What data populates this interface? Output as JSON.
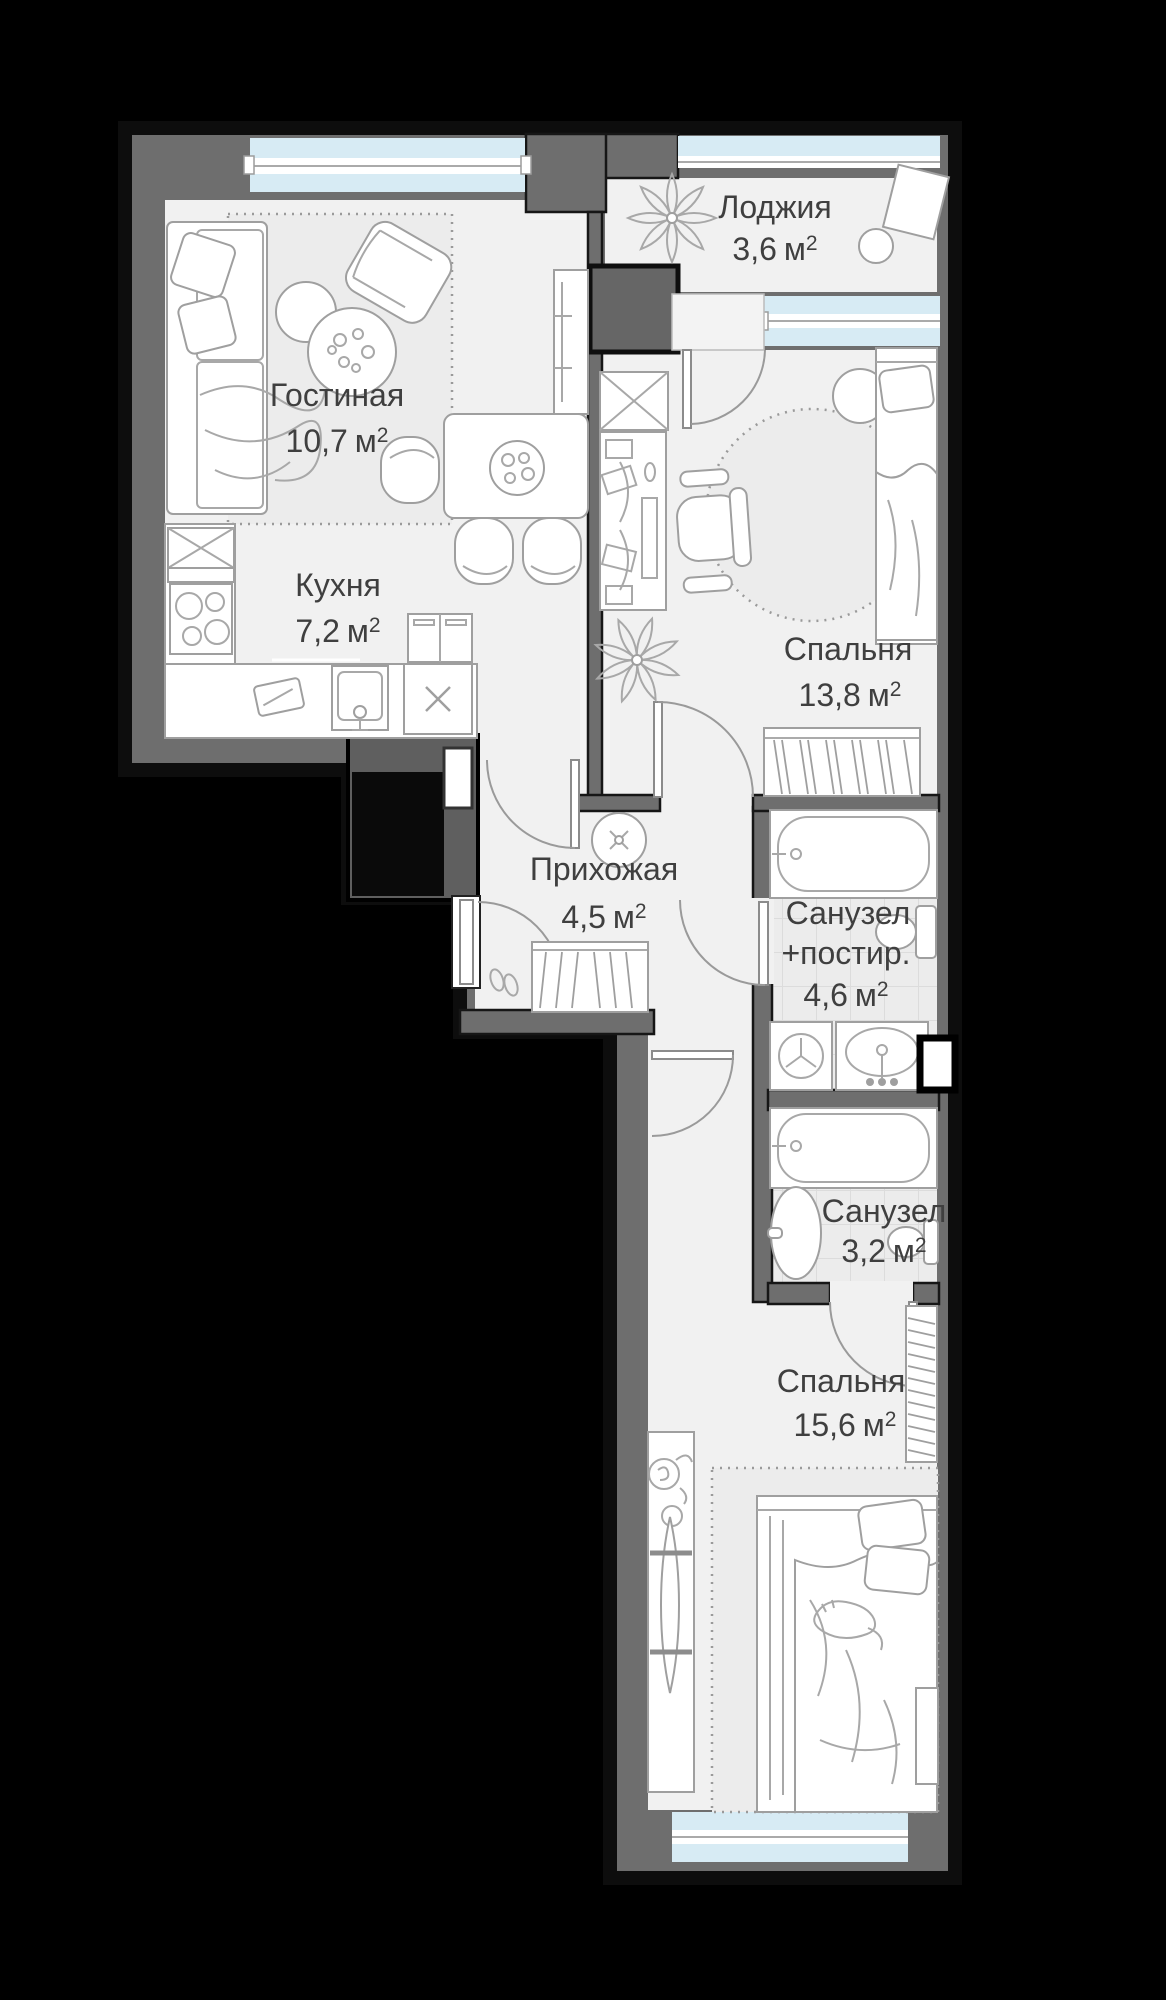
{
  "units": {
    "meter": "м",
    "sup": "2"
  },
  "rooms": [
    {
      "id": "loggia",
      "name": "Лоджия",
      "area": "3,6"
    },
    {
      "id": "living",
      "name": "Гостиная",
      "area": "10,7"
    },
    {
      "id": "kitchen",
      "name": "Кухня",
      "area": "7,2"
    },
    {
      "id": "bedroom-1",
      "name": "Спальня",
      "area": "13,8"
    },
    {
      "id": "hallway",
      "name": "Прихожая",
      "area": "4,5"
    },
    {
      "id": "bathroom-laundry",
      "name": "Санузел",
      "name_line2": "+постир.",
      "area": "4,6"
    },
    {
      "id": "bathroom-2",
      "name": "Санузел",
      "area": "3,2"
    },
    {
      "id": "bedroom-2",
      "name": "Спальня",
      "area": "15,6"
    }
  ],
  "colors": {
    "background": "#000000",
    "wall": "#6e6e6e",
    "outline": "#141414",
    "floor": "#f1f1f1",
    "window_glass": "#d7ebf4",
    "bathroom_tile": "#ececec",
    "furniture_line": "#9f9f9f",
    "text": "#3f3f3f"
  },
  "furniture_icons": [
    "sofa-icon",
    "pillow-icon",
    "armchair-icon",
    "coffee-table-icon",
    "tv-unit-icon",
    "dining-table-icon",
    "chair-icon",
    "rug-icon",
    "cabinet-icon",
    "stove-icon",
    "cutting-board-icon",
    "kitchen-sink-icon",
    "dishwasher-icon",
    "fridge-icon",
    "wardrobe-icon",
    "desk-icon",
    "office-chair-icon",
    "pouf-icon",
    "single-bed-icon",
    "plant-icon",
    "round-rug-icon",
    "ceiling-lamp-icon",
    "shoes-icon",
    "closet-icon",
    "bathtub-icon",
    "washing-machine-icon",
    "sink-icon",
    "toilet-icon",
    "pedestal-sink-icon",
    "shaft-icon",
    "double-bed-icon",
    "cat-icon",
    "console-icon",
    "ironing-board-icon",
    "flower-icon",
    "stool-icon",
    "balcony-table-icon"
  ]
}
